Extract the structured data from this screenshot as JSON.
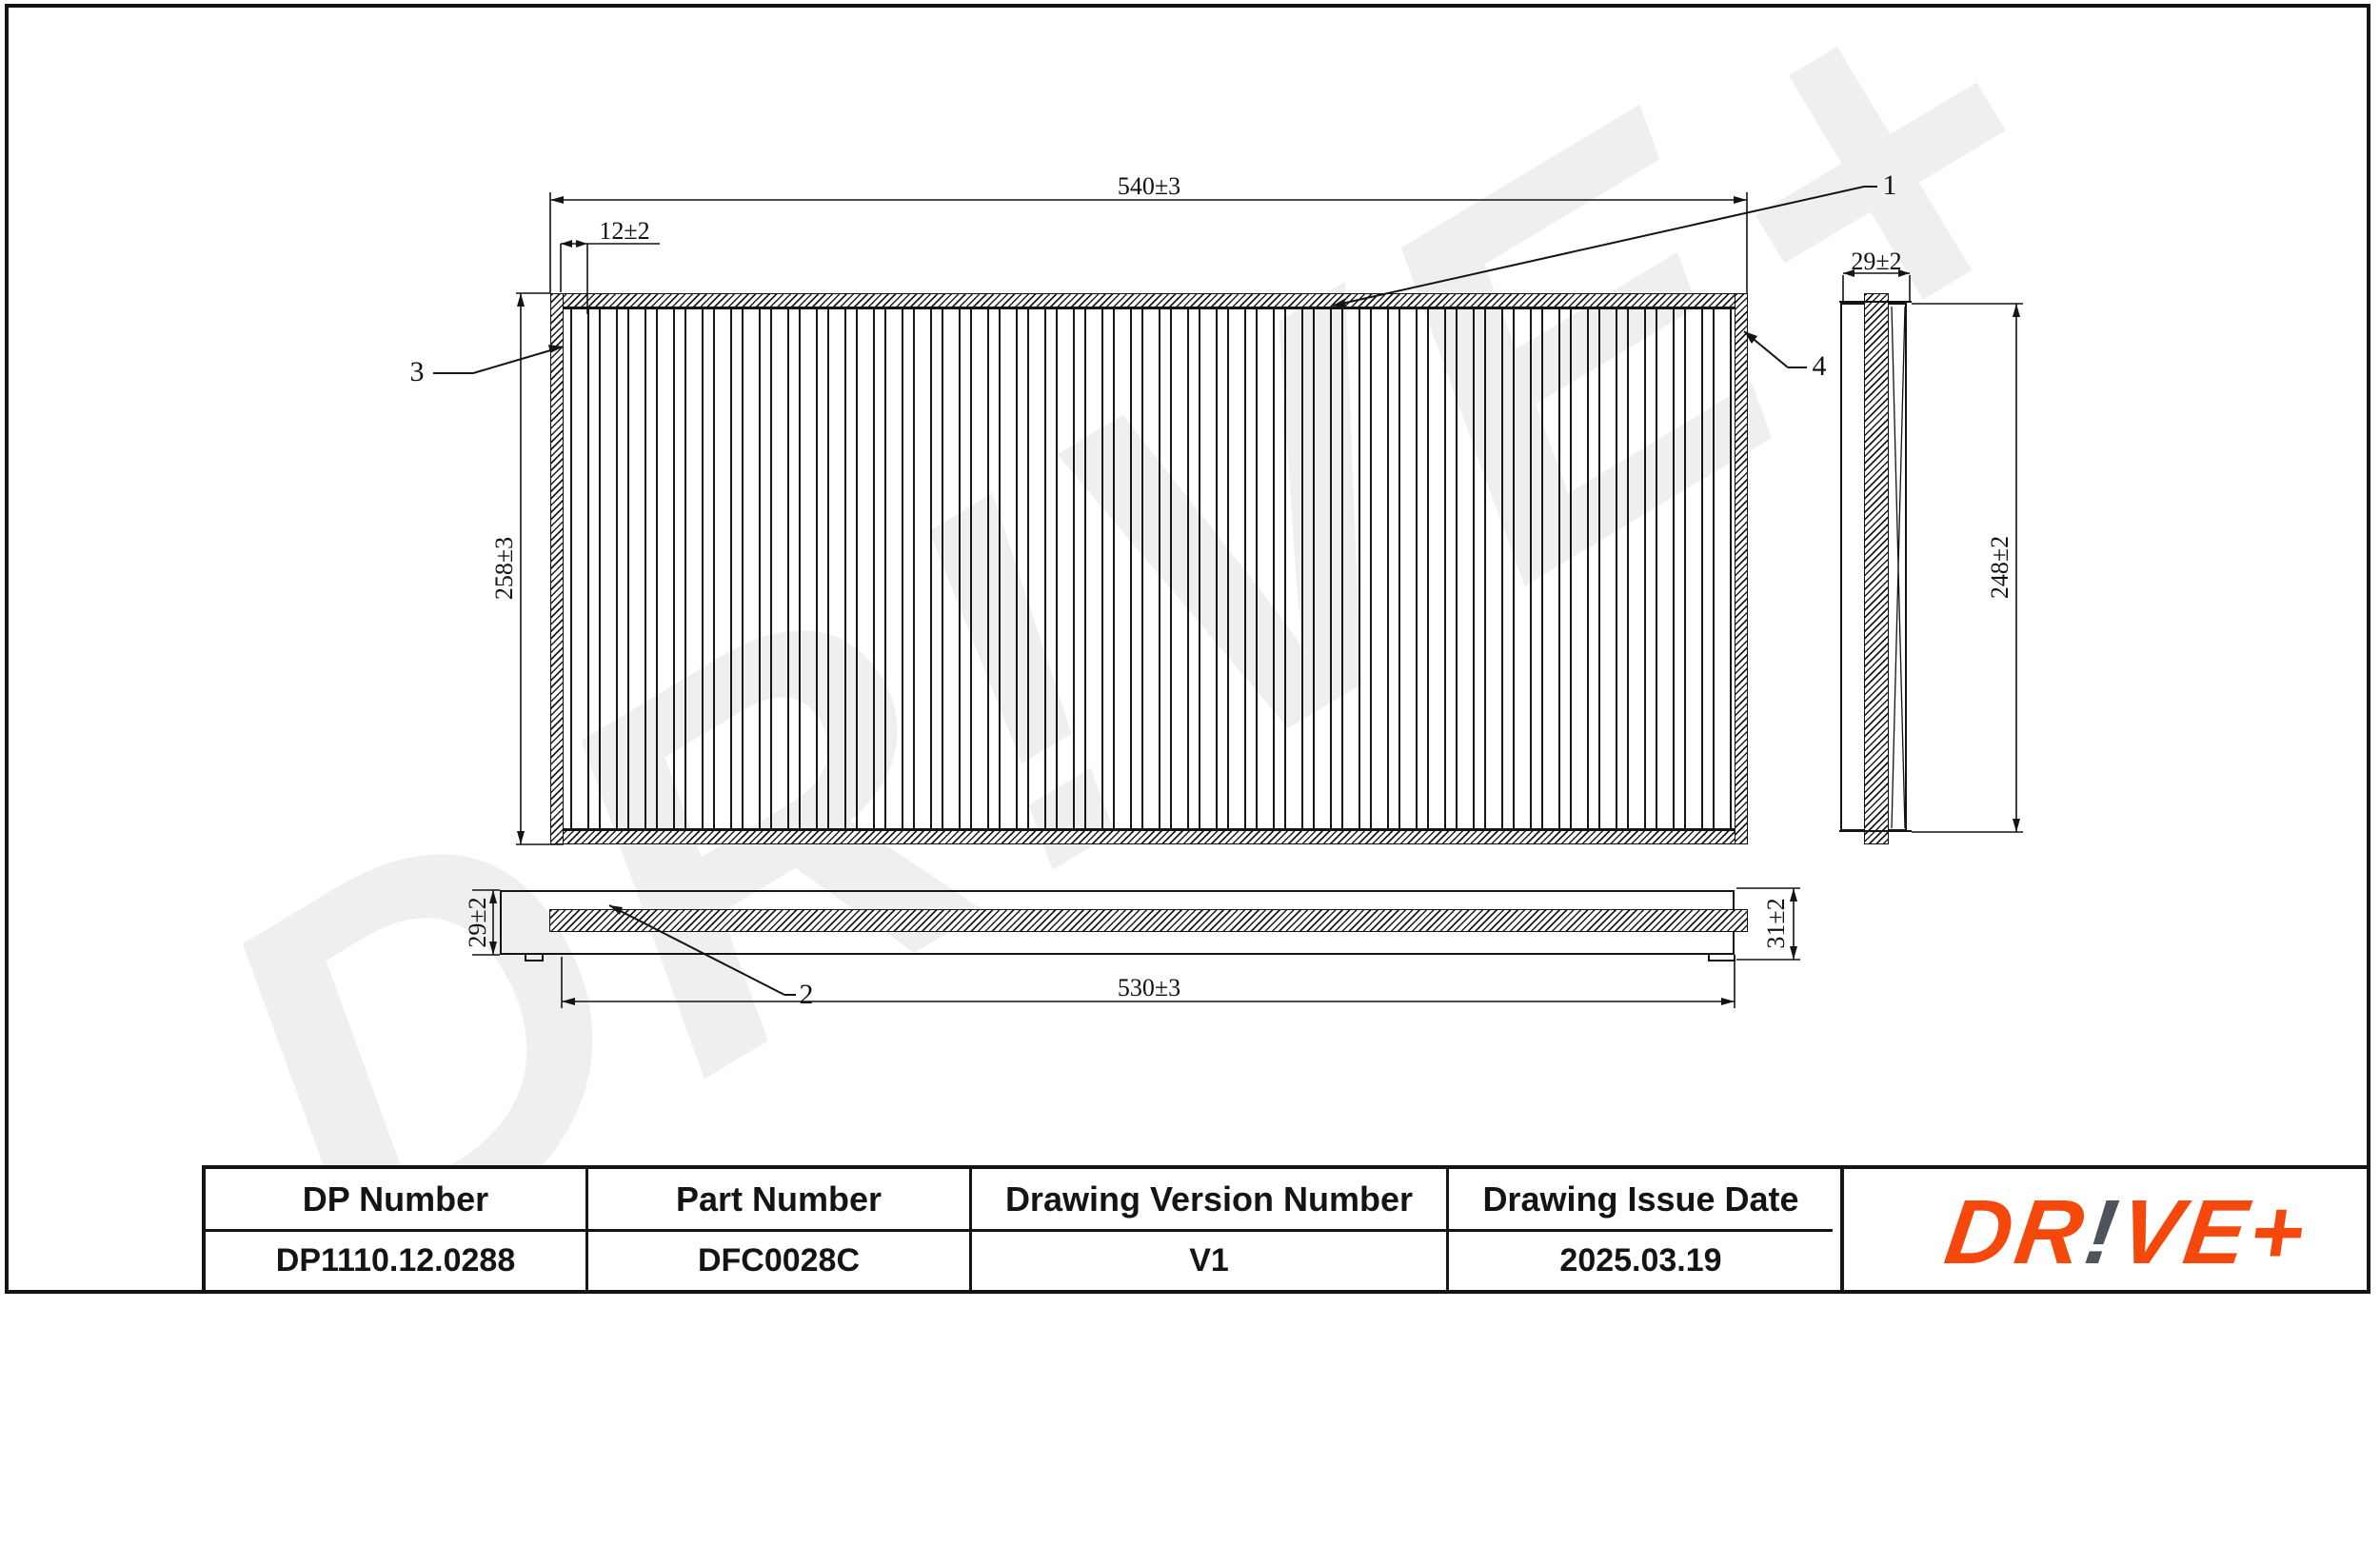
{
  "watermark": {
    "text": "DR!VE+"
  },
  "drawing": {
    "dims": {
      "front_width": {
        "text": "540±3"
      },
      "front_edge_offset": {
        "text": "12±2"
      },
      "front_height": {
        "text": "258±3"
      },
      "side_width": {
        "text": "29±2"
      },
      "side_height": {
        "text": "248±2"
      },
      "bottom_left_height": {
        "text": "29±2"
      },
      "bottom_right_height": {
        "text": "31±2"
      },
      "bottom_width": {
        "text": "530±3"
      }
    },
    "callouts": {
      "c1": "1",
      "c2": "2",
      "c3": "3",
      "c4": "4"
    }
  },
  "table": {
    "columns": [
      {
        "header": "DP Number",
        "value": "DP1110.12.0288"
      },
      {
        "header": "Part Number",
        "value": "DFC0028C"
      },
      {
        "header": "Drawing Version Number",
        "value": "V1"
      },
      {
        "header": "Drawing Issue Date",
        "value": "2025.03.19"
      }
    ]
  },
  "logo": {
    "prefix": "DR",
    "bang": "!",
    "suffix": "VE+",
    "orange": "#F4480C",
    "gray": "#4D555A"
  }
}
